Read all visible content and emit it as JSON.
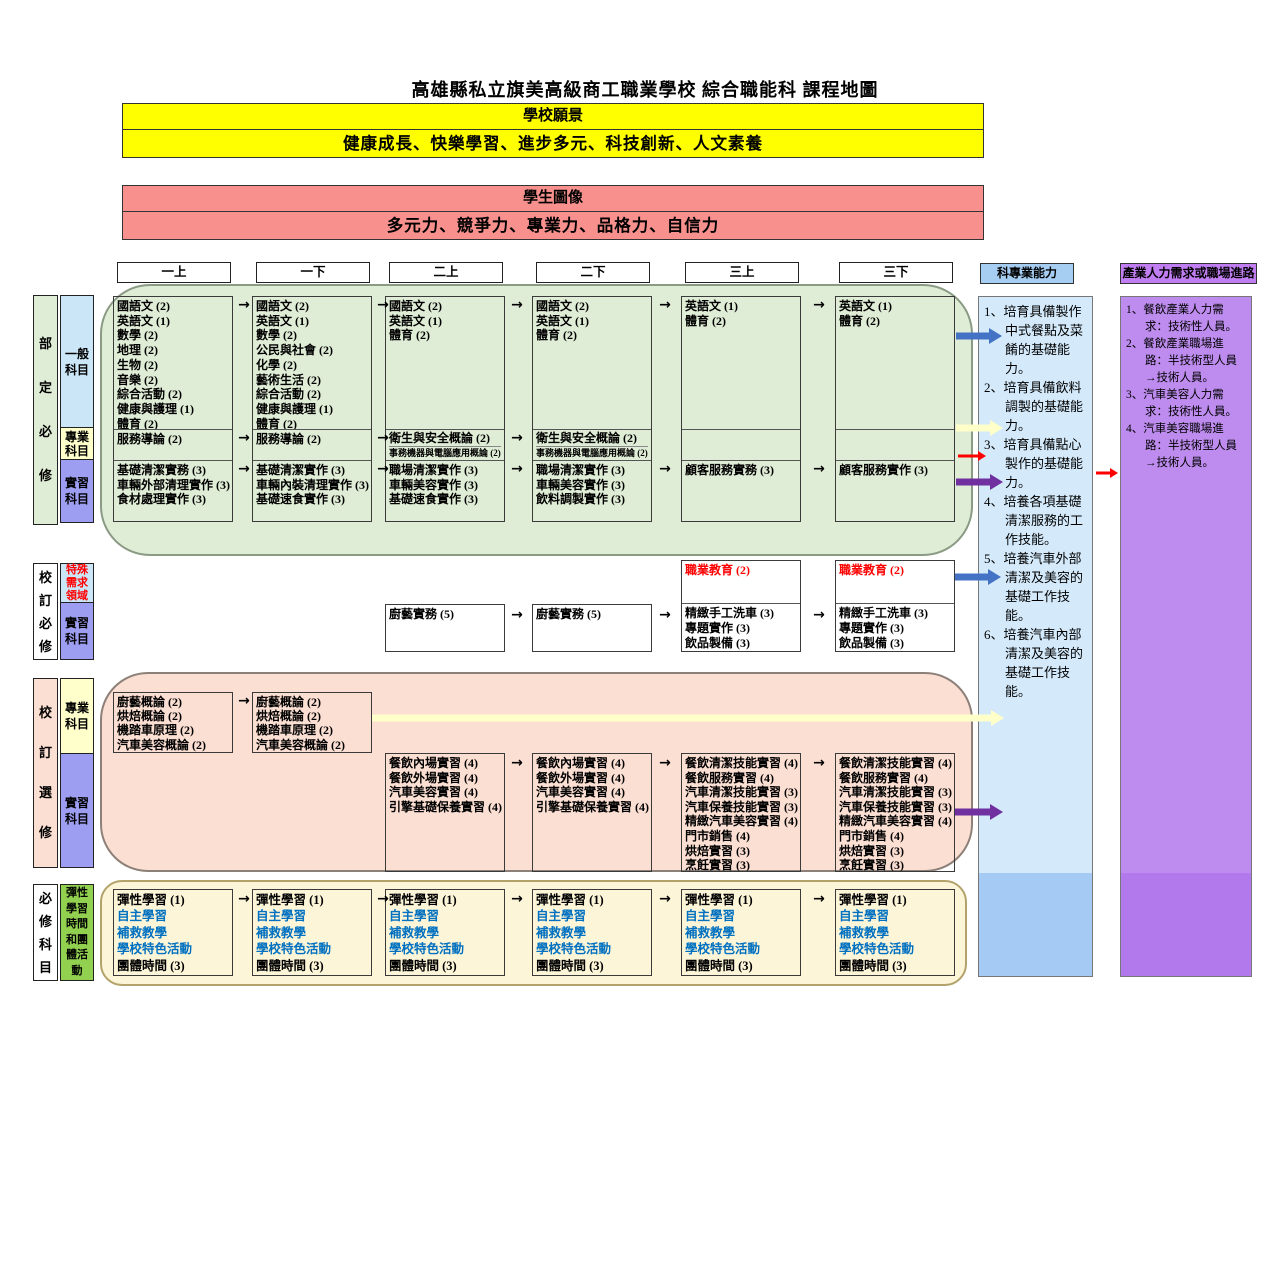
{
  "title": "高雄縣私立旗美高級商工職業學校 綜合職能科 課程地圖",
  "vision": {
    "title": "學校願景",
    "text": "健康成長、快樂學習、進步多元、科技創新、人文素養"
  },
  "student": {
    "title": "學生圖像",
    "text": "多元力、競爭力、專業力、品格力、自信力"
  },
  "semesters": [
    "一上",
    "一下",
    "二上",
    "二下",
    "三上",
    "三下"
  ],
  "colors": {
    "arrow_blue": "#4472c4",
    "arrow_red": "#fe0000",
    "arrow_purple": "#7030a0",
    "arrow_pale_yellow": "#ffffc9",
    "banner_yellow": "#ffff00",
    "banner_pink": "#f8918d",
    "green_area": "#e0edd6",
    "pink_area": "#fcdfd3",
    "cream_area": "#fdf5d8",
    "sub_blue": "#cbe7f7",
    "sub_yellow": "#ffffcc",
    "sub_periwinkle": "#9d9df1",
    "sub_green": "#92d050",
    "ability_header": "#a6cdf2",
    "ability_body": "#d4eafb",
    "ability_body_bottom": "#a5caf3",
    "industry_header": "#c17ef2",
    "industry_body": "#bd8cee",
    "industry_body_bottom": "#b279ec",
    "blue_text": "#0070c0",
    "red_text": "#fe0000"
  },
  "ministry": {
    "label": "部定必修",
    "sub_general": "一般科目",
    "sub_professional": "專業科目",
    "sub_practicum": "實習科目",
    "general": [
      [
        "國語文 (2)",
        "英語文 (1)",
        "數學 (2)",
        "地理 (2)",
        "生物 (2)",
        "音樂 (2)",
        "綜合活動 (2)",
        "健康與護理 (1)",
        "體育 (2)"
      ],
      [
        "國語文 (2)",
        "英語文 (1)",
        "數學 (2)",
        "公民與社會 (2)",
        "化學 (2)",
        "藝術生活 (2)",
        "綜合活動 (2)",
        "健康與護理 (1)",
        "體育 (2)"
      ],
      [
        "國語文 (2)",
        "英語文 (1)",
        "體育 (2)"
      ],
      [
        "國語文 (2)",
        "英語文 (1)",
        "體育 (2)"
      ],
      [
        "英語文 (1)",
        "體育 (2)"
      ],
      [
        "英語文 (1)",
        "體育 (2)"
      ]
    ],
    "professional_intro": "服務導論 (2)",
    "professional_hygiene": "衛生與安全概論 (2)",
    "professional_office": "事務機器與電腦應用概論 (2)",
    "practicum": [
      [
        "基礎清潔實務 (3)",
        "車輛外部清理實作 (3)",
        "食材處理實作 (3)"
      ],
      [
        "基礎清潔實作 (3)",
        "車輛內裝清理實作 (3)",
        "基礎速食實作 (3)"
      ],
      [
        "職場清潔實作 (3)",
        "車輛美容實作 (3)",
        "基礎速食實作 (3)"
      ],
      [
        "職場清潔實作 (3)",
        "車輛美容實作 (3)",
        "飲料調製實作 (3)"
      ],
      [
        "顧客服務實務 (3)"
      ],
      [
        "顧客服務實作 (3)"
      ]
    ]
  },
  "school_required": {
    "label": "校訂必修",
    "sub_special": "特殊需求領域",
    "sub_practicum": "實習科目",
    "culinary": "廚藝實務 (5)",
    "vocational": "職業教育 (2)",
    "practicum_year3": [
      "精緻手工洗車 (3)",
      "專題實作 (3)",
      "飲品製備 (3)"
    ]
  },
  "school_elective": {
    "label": "校訂選修",
    "sub_professional": "專業科目",
    "sub_practicum": "實習科目",
    "intro_courses": [
      "廚藝概論 (2)",
      "烘焙概論 (2)",
      "機踏車原理 (2)",
      "汽車美容概論 (2)"
    ],
    "practicum_year2": [
      "餐飲內場實習 (4)",
      "餐飲外場實習 (4)",
      "汽車美容實習 (4)",
      "引擎基礎保養實習 (4)"
    ],
    "practicum_year3": [
      "餐飲清潔技能實習 (4)",
      "餐飲服務實習 (4)",
      "汽車清潔技能實習 (3)",
      "汽車保養技能實習 (3)",
      "精緻汽車美容實習 (4)",
      "門市銷售 (4)",
      "烘焙實習 (3)",
      "烹飪實習 (3)"
    ]
  },
  "flex": {
    "label": "必修科目",
    "sub": "彈性學習時間和團體活動",
    "line1": "彈性學習 (1)",
    "blue_lines": [
      "自主學習",
      "補救教學",
      "學校特色活動"
    ],
    "line5": "團體時間 (3)"
  },
  "abilities": {
    "header": "科專業能力",
    "items": [
      "1、培育具備製作中式餐點及菜餚的基礎能力。",
      "2、培育具備飲料調製的基礎能力。",
      "3、培育具備點心製作的基礎能力。",
      "4、培養各項基礎清潔服務的工作技能。",
      "5、培養汽車外部清潔及美容的基礎工作技能。",
      "6、培養汽車內部清潔及美容的基礎工作技能。"
    ]
  },
  "industry": {
    "header": "產業人力需求或職場進路",
    "items": [
      "1、餐飲產業人力需求：技術性人員。",
      "2、餐飲產業職場進路：半技術型人員→技術人員。",
      "3、汽車美容人力需求：技術性人員。",
      "4、汽車美容職場進路：半技術型人員→技術人員。"
    ]
  }
}
